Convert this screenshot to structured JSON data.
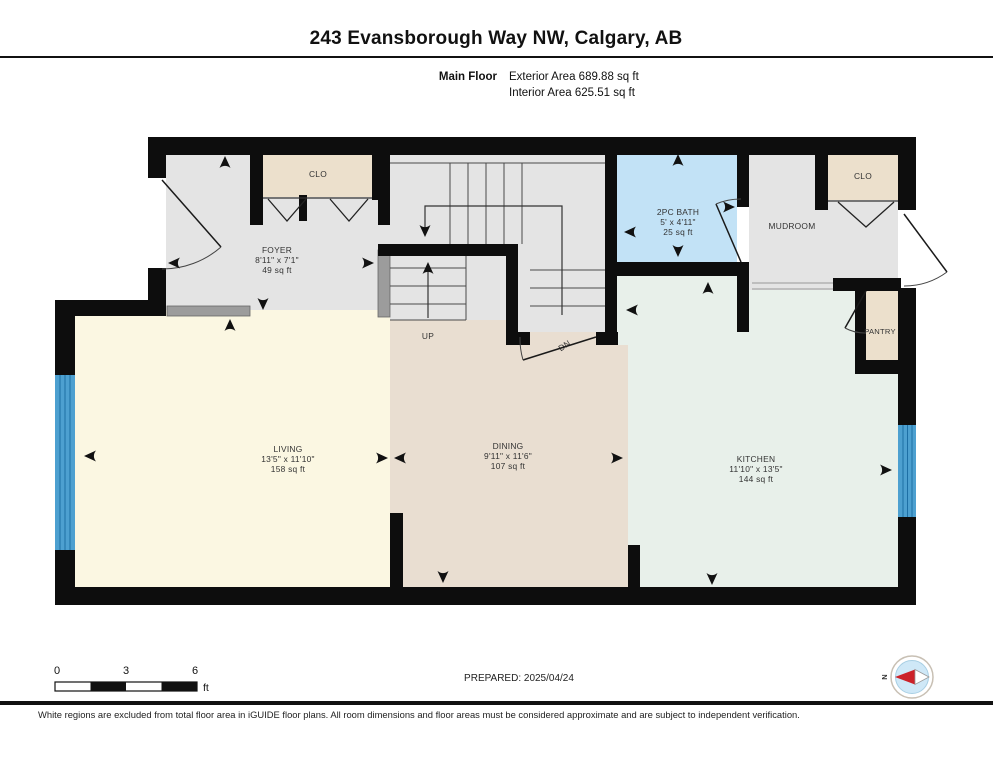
{
  "header": {
    "title": "243 Evansborough Way NW, Calgary, AB",
    "floor_label": "Main Floor",
    "exterior_area": "Exterior Area 689.88 sq ft",
    "interior_area": "Interior Area 625.51 sq ft"
  },
  "rooms": {
    "foyer": {
      "name": "FOYER",
      "dims": "8'11\" x 7'1\"",
      "area": "49 sq ft",
      "color": "#e4e4e4"
    },
    "bath": {
      "name": "2PC BATH",
      "dims": "5' x 4'11\"",
      "area": "25 sq ft",
      "color": "#c2e2f6"
    },
    "mudroom": {
      "name": "MUDROOM",
      "color": "#e4e4e4"
    },
    "living": {
      "name": "LIVING",
      "dims": "13'5\" x 11'10\"",
      "area": "158 sq ft",
      "color": "#fbf7e2"
    },
    "dining": {
      "name": "DINING",
      "dims": "9'11\" x 11'6\"",
      "area": "107 sq ft",
      "color": "#e9ded1"
    },
    "kitchen": {
      "name": "KITCHEN",
      "dims": "11'10\" x 13'5\"",
      "area": "144 sq ft",
      "color": "#e8f0ea"
    },
    "pantry": {
      "name": "PANTRY",
      "color": "#ece0cc"
    },
    "foyer_closet": {
      "name": "CLO",
      "color": "#ece0cc"
    },
    "mud_closet": {
      "name": "CLO",
      "color": "#ece0cc"
    }
  },
  "stairs": {
    "up": "UP",
    "down": "DN"
  },
  "scale": {
    "t0": "0",
    "t3": "3",
    "t6": "6",
    "unit": "ft"
  },
  "footer": {
    "prepared": "PREPARED: 2025/04/24",
    "disclaimer": "White regions are excluded from total floor area in iGUIDE floor plans. All room dimensions and floor areas must be considered approximate and are subject to independent verification."
  },
  "compass": {
    "north": "N",
    "needle_color": "#cc2128",
    "face_color": "#cfe8f7"
  },
  "colors": {
    "wall": "#0d0d0d",
    "window_fill": "#4da0d0",
    "window_line": "#1d6fa5",
    "railing": "#9c9c9c"
  }
}
